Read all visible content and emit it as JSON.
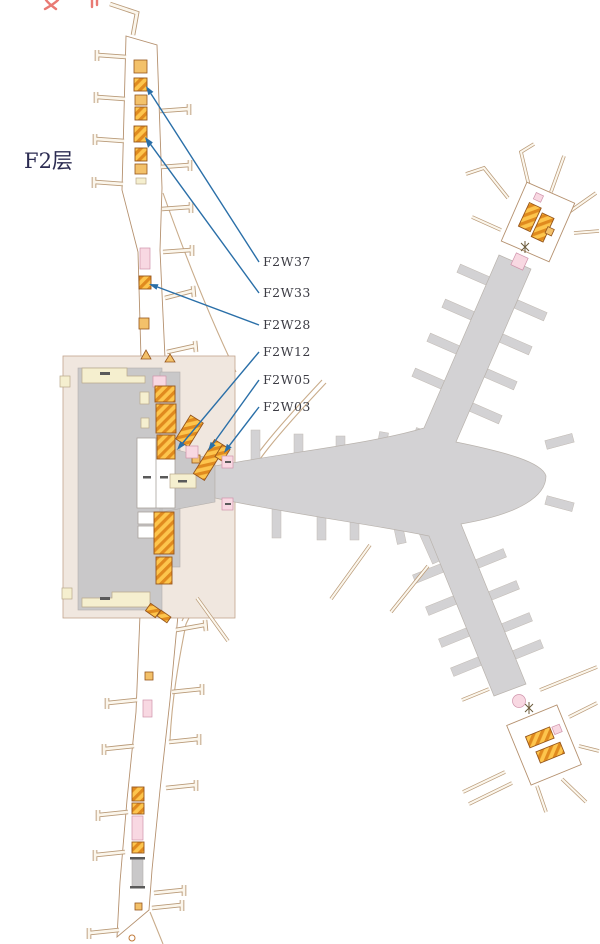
{
  "page": {
    "floor_label": "F2层",
    "background": "#ffffff"
  },
  "annotations": {
    "labels": [
      {
        "text": "F2W37"
      },
      {
        "text": "F2W33"
      },
      {
        "text": "F2W28"
      },
      {
        "text": "F2W12"
      },
      {
        "text": "F2W05"
      },
      {
        "text": "F2W03"
      }
    ],
    "leader_color": "#2a6fa8",
    "label_color": "#3c3c44"
  },
  "legend_colors": {
    "concourse_fill": "#ffffff",
    "concourse_outline": "#b5916f",
    "walkway_gray": "#d3d2d4",
    "terminal_gray": "#c9c8c9",
    "terminal_apron": "#f0e7df",
    "service_cream": "#f5efcf",
    "shop_gold": "#fdc54d",
    "shop_stripe": "#e08a1e",
    "kiosk_pink": "#f8d8e2",
    "truncated_text_red": "#e97a74",
    "floor_title_color": "#2c2c52"
  }
}
